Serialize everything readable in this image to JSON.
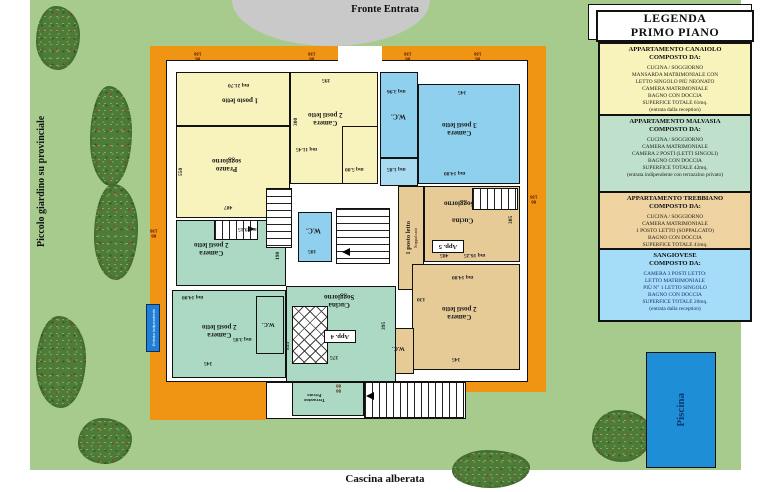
{
  "surroundings": {
    "fronte_entrata": "Fronte Entrata",
    "piccolo_giardino": "Piccolo giardino su provinciale",
    "veduta_vigneti": "Veduta su Vigneti",
    "cascina_alberata": "Cascina alberata",
    "pool": "Piscina",
    "entrance_marker": "Entrata Indipendente"
  },
  "legend": {
    "title": "LEGENDA\nPRIMO PIANO",
    "sections": [
      {
        "title": "APPARTAMENTO CANAIOLO\nCOMPOSTO DA:",
        "body": "CUCINA / SOGGIORNO\nMANSARDA MATRIMONIALE CON\nLETTO SINGOLO PIÙ NEONATO\nCAMERA MATRIMONIALE\nBAGNO CON DOCCIA\nSUPERFICE TOTALE 61mq.\n(entrata dalla reception)",
        "color": "#f8f3bb"
      },
      {
        "title": "APPARTAMENTO  MALVASIA\nCOMPOSTO DA:",
        "body": "CUCINA / SOGGIORNO\nCAMERA MATRIMONIALE\nCAMERA 2 POSTI (LETTI SINGOLI)\nBAGNO CON DOCCIA\nSUPERFICE TOTALE 42mq.\n(entrata indipendente con terrazzino privato)",
        "color": "#bfe0cb"
      },
      {
        "title": "APPARTAMENTO  TREBBIANO\nCOMPOSTO DA:",
        "body": "CUCINA / SOGGIORNO\nCAMERA MATRIMONIALE\n1 POSTO LETTO (SOPPALCATO)\nBAGNO CON DOCCIA\nSUPERFICE TOTALE 41mq.\n(entrata dalla reception)",
        "color": "#eed3a0"
      },
      {
        "title": "SANGIOVESE\nCOMPOSTO DA:",
        "body": "CAMERA 3 POSTI LETTO:\nLETTO MATRIMONIALE\nPIÙ N° 1 LETTO SINGOLO\nBAGNO CON DOCCIA\nSUPERFICE TOTALE 20mq.\n(entrata dalla reception)",
        "color": "#a5dcf7"
      }
    ]
  },
  "plan": {
    "rooms": {
      "posto1": {
        "name": "1 posto letto",
        "area": "mq 21.70"
      },
      "pranzo": {
        "name": "Pranzo\nsoggiorno",
        "dim_left": "550",
        "dim_bottom": "487"
      },
      "camera2_yellow": {
        "name": "Camera\n2 posti letto",
        "area": "mq 11.45",
        "dim_top": "395",
        "dim_side": "300"
      },
      "closet_yellow": {
        "area": "mq 5.00"
      },
      "cell_blue": {
        "area": "mq 1.85"
      },
      "wc_blue": {
        "name": "W.C.",
        "area": "mq 3.96"
      },
      "camera3_blue": {
        "name": "Camera\n3 posti letto",
        "area": "mq 14.80",
        "dim_top": "345"
      },
      "wc_center": {
        "name": "W.C.",
        "dim": "105"
      },
      "soppalco": {
        "name": "1 posto letto",
        "sub": "Soppalcato"
      },
      "app5": {
        "name1": "Soggiorno",
        "name2": "Cucina",
        "tag": "App. 5",
        "area": "mq 16.25",
        "dim": "485",
        "dim_side": "305"
      },
      "camera2_tan": {
        "name": "Camera\n2 posti letto",
        "area": "mq 14.80",
        "dim": "345",
        "dim_left": "130"
      },
      "wc_tan": {
        "name": "W.C."
      },
      "camera2_green_up": {
        "name": "Camera\n2 posti letto",
        "area": "mq 9.15",
        "dim_side": "190"
      },
      "camera2_green_low": {
        "name": "Camera\n2 posti letto",
        "area": "mq 14.00",
        "dim": "345",
        "area_wc": "mq 3.05"
      },
      "wc_green": {
        "name": "W.C.",
        "dim": "855"
      },
      "app4": {
        "name": "Cucina\nSoggiorno",
        "tag": "App. 4",
        "dim": "375",
        "dim_side": "395"
      },
      "terrazzino": {
        "name": "Terrazzino\nPrivato",
        "dim": "80\n80"
      }
    },
    "windows": [
      "86\n136",
      "86\n136",
      "86\n136",
      "86\n136",
      "86\n136",
      "86\n136"
    ]
  },
  "colors": {
    "grass": "#a6cb8d",
    "building_outline": "#ef9413",
    "canaiolo_yellow": "#f8f3bd",
    "malvasia_green": "#abd9c3",
    "trebbiano_tan": "#e6cb97",
    "sangiovese_blue": "#8fd0ee",
    "pool_blue": "#1e8ed6",
    "dome_gray": "#c9c9c9"
  }
}
